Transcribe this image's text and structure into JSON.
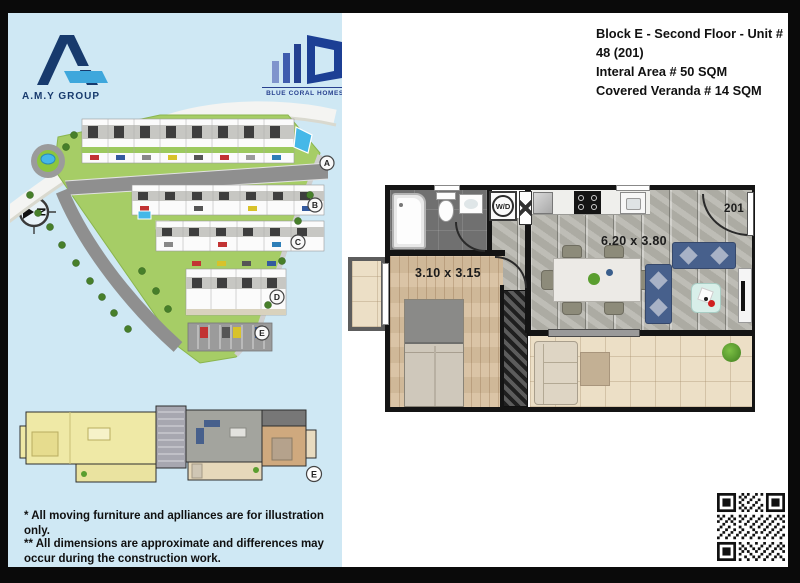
{
  "colors": {
    "panel_blue": "#cfe8f4",
    "brand_navy": "#173a6d",
    "brand_lightblue": "#3ea7dc",
    "land_green": "#a6cd66",
    "sofa_blue": "#47608c",
    "alert_red": "#d02020"
  },
  "left_panel": {
    "amy_logo_label": "A.M.Y GROUP",
    "bch_logo_label": "BLUE CORAL HOMES",
    "compass_letter": "N",
    "site_plan": {
      "block_labels": [
        "A",
        "B",
        "C",
        "D",
        "E"
      ]
    },
    "key_plan": {
      "block_label": "E"
    },
    "disclaimer_1": "* All moving furniture and aplliances are for illustration only.",
    "disclaimer_2": "** All dimensions are approximate and differences may occur during the construction work."
  },
  "right_panel": {
    "header": {
      "line1": "Block E - Second Floor - Unit # 48 (201)",
      "line2": "Interal Area # 50 SQM",
      "line3": "Covered Veranda # 14 SQM"
    },
    "floor_plan": {
      "bedroom_dim": "3.10 x 3.15",
      "living_dim": "6.20 x 3.80",
      "unit_number": "201",
      "washer_dryer_label": "W/D"
    }
  }
}
